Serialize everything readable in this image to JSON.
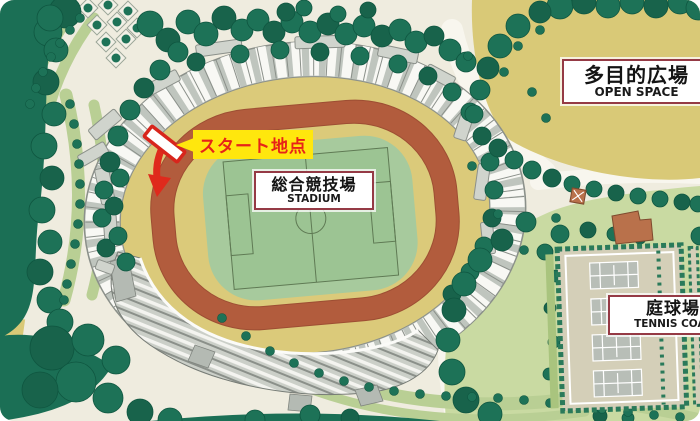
{
  "labels": {
    "open_space": {
      "ja": "多目的広場",
      "en": "OPEN SPACE"
    },
    "stadium": {
      "ja": "総合競技場",
      "en": "STADIUM"
    },
    "tennis": {
      "ja": "庭球場",
      "en": "TENNIS COAT"
    },
    "start_point": "スタート地点"
  },
  "colors": {
    "label_border": "#953a45",
    "start_text": "#e72318",
    "start_bg": "#ffe70d",
    "arrow_red": "#df2a1c",
    "track_red": "#b25c3d",
    "field_green": "#9cc493",
    "open_space_tan": "#d9c977",
    "tree_green": "#1d7257",
    "map_background": "#efecdf"
  }
}
